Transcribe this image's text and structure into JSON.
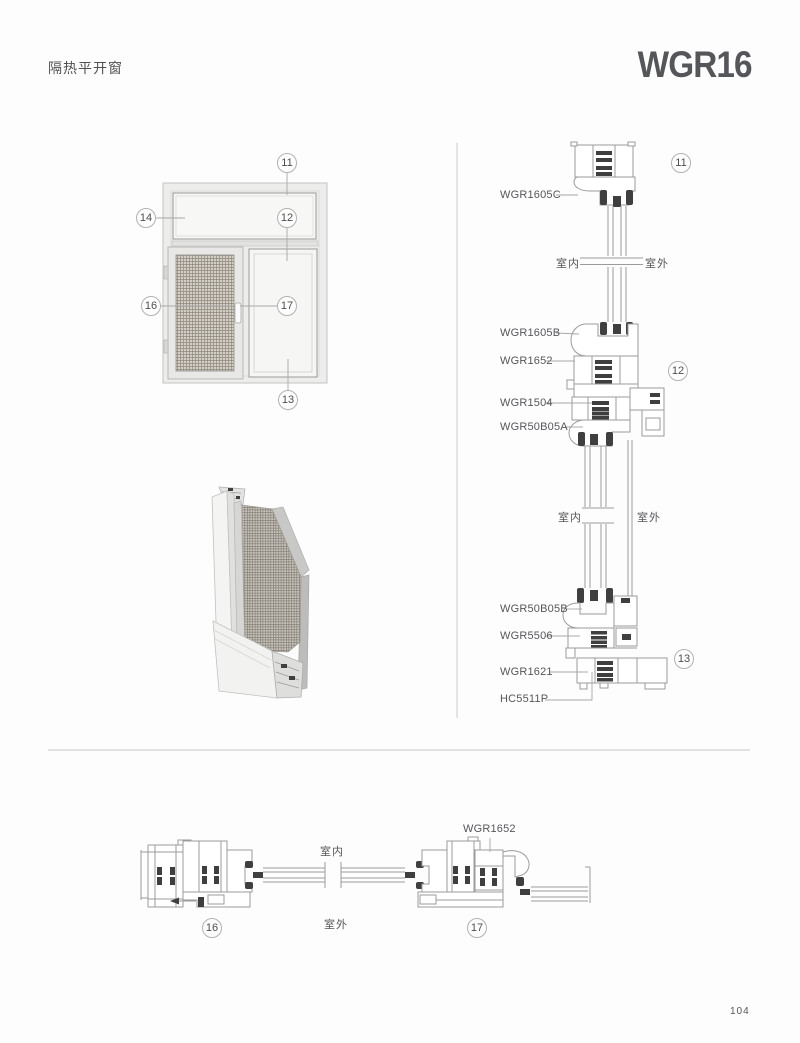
{
  "header": {
    "subtitle": "隔热平开窗",
    "title": "WGR16"
  },
  "page_number": "104",
  "elevation": {
    "callouts": [
      {
        "num": "11"
      },
      {
        "num": "14"
      },
      {
        "num": "12"
      },
      {
        "num": "16"
      },
      {
        "num": "17"
      },
      {
        "num": "13"
      }
    ]
  },
  "vertical_section": {
    "callouts": [
      {
        "num": "11"
      },
      {
        "num": "12"
      },
      {
        "num": "13"
      }
    ],
    "labels": [
      {
        "text": "WGR1605C"
      },
      {
        "text": "WGR1605B"
      },
      {
        "text": "WGR1652"
      },
      {
        "text": "WGR1504"
      },
      {
        "text": "WGR50B05A"
      },
      {
        "text": "WGR50B05B"
      },
      {
        "text": "WGR5506"
      },
      {
        "text": "WGR1621"
      },
      {
        "text": "HC5511P"
      }
    ],
    "markers": {
      "indoor": "室内",
      "outdoor": "室外"
    }
  },
  "horizontal_section": {
    "callouts": [
      {
        "num": "16"
      },
      {
        "num": "17"
      }
    ],
    "label": "WGR1652",
    "markers": {
      "indoor": "室内",
      "outdoor": "室外"
    }
  },
  "colors": {
    "line_gray": "#9b9b9b",
    "dark_detail": "#3f3f3f",
    "text_gray": "#55565a"
  }
}
